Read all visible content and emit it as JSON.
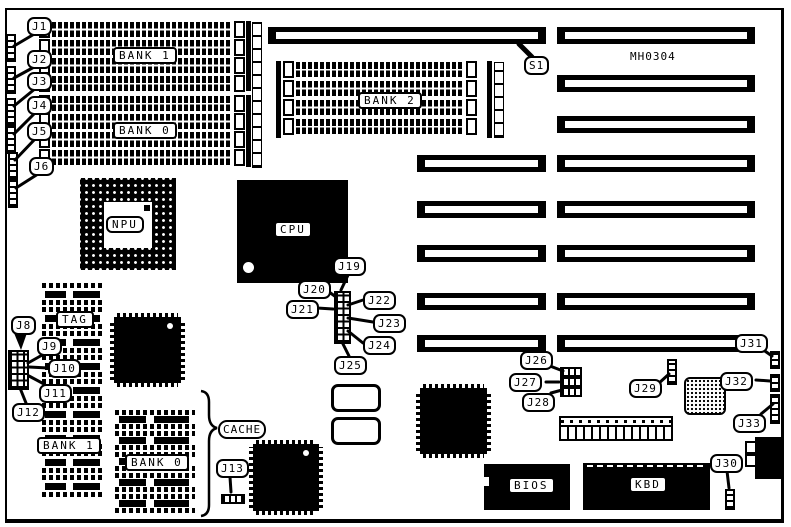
{
  "board": {
    "model": "MH0304"
  },
  "labels": {
    "bank1_simm": "BANK 1",
    "bank0_simm": "BANK 0",
    "bank2_simm": "BANK 2",
    "npu": "NPU",
    "cpu": "CPU",
    "tag": "TAG",
    "cache": "CACHE",
    "bank1_dram": "BANK 1",
    "bank0_dram": "BANK 0",
    "bios": "BIOS",
    "kbd": "KBD"
  },
  "connectors": {
    "s1": "S1"
  },
  "jumpers": {
    "j1": "J1",
    "j2": "J2",
    "j3": "J3",
    "j4": "J4",
    "j5": "J5",
    "j6": "J6",
    "j8": "J8",
    "j9": "J9",
    "j10": "J10",
    "j11": "J11",
    "j12": "J12",
    "j13": "J13",
    "j19": "J19",
    "j20": "J20",
    "j21": "J21",
    "j22": "J22",
    "j23": "J23",
    "j24": "J24",
    "j25": "J25",
    "j26": "J26",
    "j27": "J27",
    "j28": "J28",
    "j29": "J29",
    "j30": "J30",
    "j31": "J31",
    "j32": "J32",
    "j33": "J33"
  }
}
